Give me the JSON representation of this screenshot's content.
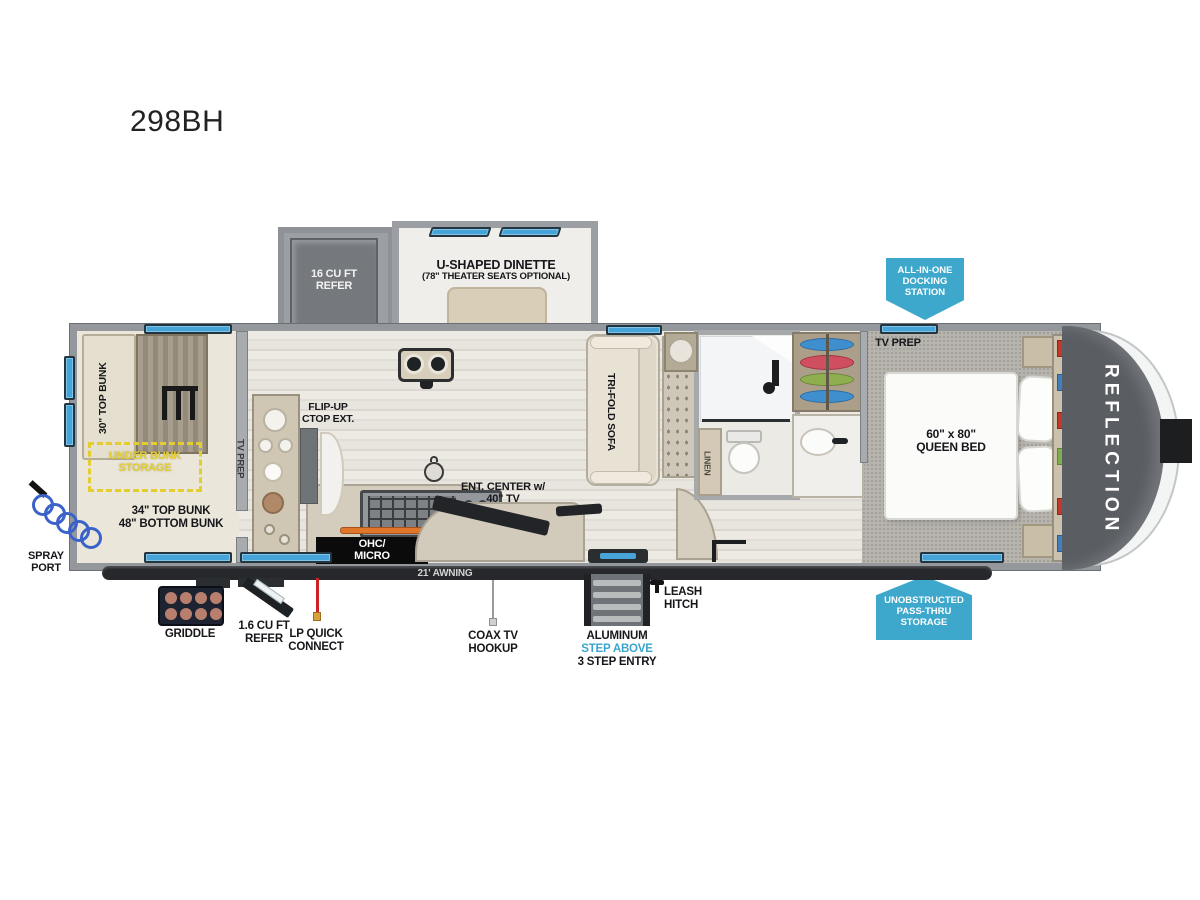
{
  "title": "298BH",
  "brand": "REFLECTION",
  "slides": {
    "refer": "16 CU FT\nREFER",
    "dinette_title": "U-SHAPED DINETTE",
    "dinette_sub": "(78\" THEATER SEATS OPTIONAL)"
  },
  "interior": {
    "top_bunk_30": "30\" TOP BUNK",
    "under_bunk_storage": "UNDER BUNK\nSTORAGE",
    "bunks_34_48": "34\" TOP BUNK\n48\" BOTTOM BUNK",
    "tv_prep_bunk": "TV PREP",
    "flip_up_ctop": "FLIP-UP\nCTOP EXT.",
    "ohc_micro": "OHC/\nMICRO",
    "ent_center": "ENT. CENTER w/\n40\" TV",
    "tri_fold_sofa": "TRI-FOLD SOFA",
    "linen": "LINEN",
    "tv_prep_bedroom": "TV PREP",
    "queen_bed": "60\" x 80\"\nQUEEN BED"
  },
  "badges": {
    "docking_station": "ALL-IN-ONE\nDOCKING\nSTATION",
    "pass_thru_storage": "UNOBSTRUCTED\nPASS-THRU\nSTORAGE"
  },
  "exterior": {
    "awning": "21' AWNING",
    "spray_port": "SPRAY\nPORT",
    "griddle": "GRIDDLE",
    "refer_1_6": "1.6 CU FT\nREFER",
    "lp_quick_connect": "LP QUICK\nCONNECT",
    "coax_tv_hookup": "COAX TV\nHOOKUP",
    "entry_step_line1": "ALUMINUM",
    "entry_step_line2": "STEP ABOVE",
    "entry_step_line3": "3 STEP ENTRY",
    "leash_hitch": "LEASH\nHITCH"
  },
  "colors": {
    "badge_blue": "#3da8cb",
    "window_blue": "#46a4d9",
    "storage_yellow": "#e3cd30",
    "lp_red": "#cc2222"
  }
}
